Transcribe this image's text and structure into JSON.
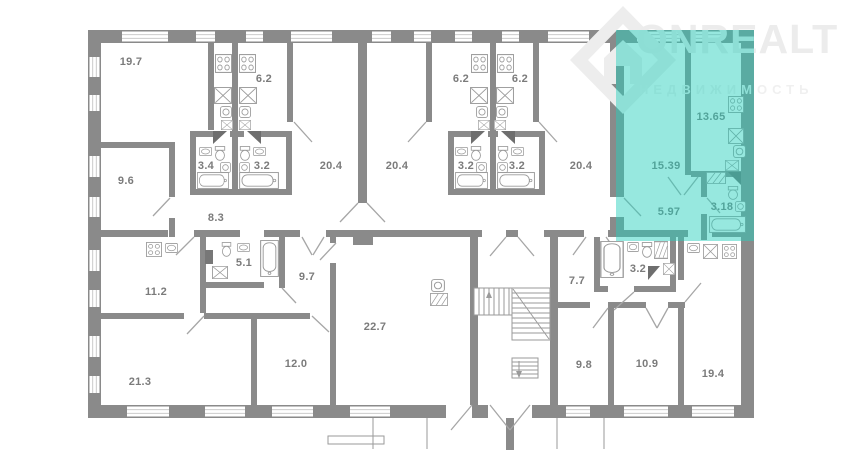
{
  "background": "#ffffff",
  "logo": {
    "brand": "ONREALT",
    "tagline": "НЕДВИЖИМОСТЬ"
  },
  "palette": {
    "wall": "#8a8a8a",
    "fixture_line": "#9a9a9a",
    "window_line": "#c4c4c4",
    "label_text": "#7b7b7b",
    "highlight_overlay": "rgba(38,207,188,0.48)",
    "logo_watermark": "#ececec"
  },
  "floor_plan": {
    "rooms": [
      {
        "type": "living-room",
        "area": "19.7"
      },
      {
        "type": "kitchen",
        "area": "6.2"
      },
      {
        "type": "room",
        "area": "20.4"
      },
      {
        "type": "room",
        "area": "20.4"
      },
      {
        "type": "kitchen",
        "area": "6.2"
      },
      {
        "type": "kitchen",
        "area": "6.2"
      },
      {
        "type": "room",
        "area": "20.4"
      },
      {
        "type": "bathroom",
        "area": "3.4"
      },
      {
        "type": "bathroom",
        "area": "3.2"
      },
      {
        "type": "bathroom",
        "area": "3.2"
      },
      {
        "type": "bathroom",
        "area": "3.2"
      },
      {
        "type": "room",
        "area": "9.6"
      },
      {
        "type": "hallway",
        "area": "8.3"
      },
      {
        "type": "kitchen",
        "area": "11.2"
      },
      {
        "type": "bathroom",
        "area": "5.1"
      },
      {
        "type": "hallway",
        "area": "9.7"
      },
      {
        "type": "room",
        "area": "22.7"
      },
      {
        "type": "room",
        "area": "12.0"
      },
      {
        "type": "room",
        "area": "21.3"
      },
      {
        "type": "hallway",
        "area": "7.7"
      },
      {
        "type": "bathroom",
        "area": "3.2"
      },
      {
        "type": "room",
        "area": "9.8"
      },
      {
        "type": "room",
        "area": "10.9"
      },
      {
        "type": "kitchen-living",
        "area": "19.4"
      }
    ],
    "highlighted_apartment": {
      "rooms": [
        {
          "type": "kitchen",
          "area": "13.65"
        },
        {
          "type": "living-room",
          "area": "15.39"
        },
        {
          "type": "hallway",
          "area": "5.97"
        },
        {
          "type": "bathroom",
          "area": "3.18"
        }
      ]
    }
  }
}
